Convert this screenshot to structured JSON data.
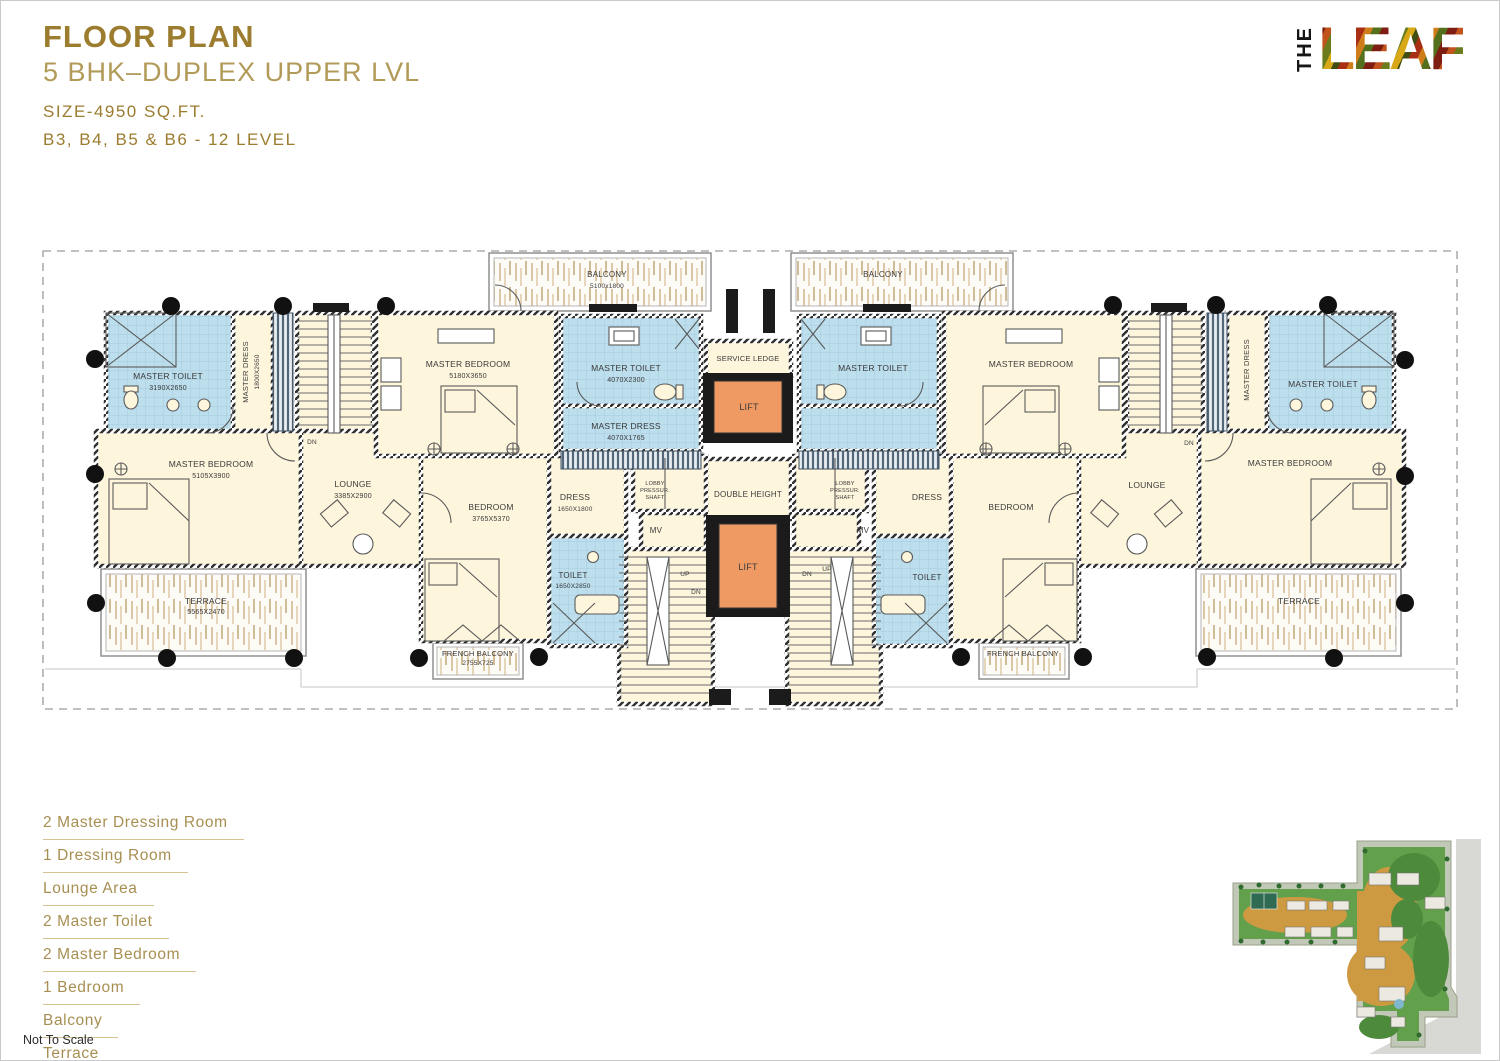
{
  "header": {
    "title": "FLOOR PLAN",
    "subtitle": "5 BHK–DUPLEX UPPER LVL",
    "size": "SIZE-4950 SQ.FT.",
    "blocks": "B3, B4, B5 & B6 - 12 LEVEL"
  },
  "logo": {
    "the": "THE",
    "leaf": "LEAF"
  },
  "features": {
    "items": [
      "2 Master Dressing Room",
      "1 Dressing Room",
      "Lounge Area",
      "2 Master Toilet",
      "2 Master Bedroom",
      "1 Bedroom",
      "Balcony",
      "Terrace"
    ]
  },
  "footnote": "Not To Scale",
  "colors": {
    "gold_dark": "#9c7c2e",
    "gold_mid": "#b29a58",
    "gold_list": "#a78f52",
    "gold_line": "#d4c291",
    "cream": "#fdf5dc",
    "wet_blue": "#bcdeed",
    "lift_orange": "#f09a63",
    "wall_dark": "#2f2f2f",
    "terrace_tan": "#d9c3a3"
  },
  "plan": {
    "labels": [
      {
        "t": "BALCONY",
        "x": 606,
        "y": 276,
        "s": 8
      },
      {
        "t": "5100x1800",
        "x": 606,
        "y": 287,
        "s": 6.5
      },
      {
        "t": "BALCONY",
        "x": 882,
        "y": 276,
        "s": 8
      },
      {
        "t": "SERVICE LEDGE",
        "x": 747,
        "y": 360,
        "s": 7.5
      },
      {
        "t": "LIFT",
        "x": 748,
        "y": 409,
        "s": 9
      },
      {
        "t": "DOUBLE HEIGHT",
        "x": 747,
        "y": 496,
        "s": 8
      },
      {
        "t": "LIFT",
        "x": 747,
        "y": 569,
        "s": 9
      },
      {
        "t": "MASTER TOILET",
        "x": 167,
        "y": 378,
        "s": 8.5
      },
      {
        "t": "3190X2650",
        "x": 167,
        "y": 389,
        "s": 7
      },
      {
        "t": "MASTER DRESS",
        "x": 247,
        "y": 371,
        "s": 7.5,
        "r": -90
      },
      {
        "t": "1800X2650",
        "x": 258,
        "y": 371,
        "s": 6.5,
        "r": -90
      },
      {
        "t": "MASTER BEDROOM",
        "x": 210,
        "y": 466,
        "s": 8.5
      },
      {
        "t": "5105X3900",
        "x": 210,
        "y": 477,
        "s": 7
      },
      {
        "t": "LOUNGE",
        "x": 352,
        "y": 486,
        "s": 8.5
      },
      {
        "t": "3385X2900",
        "x": 352,
        "y": 497,
        "s": 7
      },
      {
        "t": "DN",
        "x": 311,
        "y": 443,
        "s": 6.5
      },
      {
        "t": "MASTER BEDROOM",
        "x": 467,
        "y": 366,
        "s": 8.5
      },
      {
        "t": "5180X3650",
        "x": 467,
        "y": 377,
        "s": 7
      },
      {
        "t": "MASTER TOILET",
        "x": 625,
        "y": 370,
        "s": 8.5
      },
      {
        "t": "4070X2300",
        "x": 625,
        "y": 381,
        "s": 7
      },
      {
        "t": "MASTER DRESS",
        "x": 625,
        "y": 428,
        "s": 8.5
      },
      {
        "t": "4070X1765",
        "x": 625,
        "y": 439,
        "s": 7
      },
      {
        "t": "BEDROOM",
        "x": 490,
        "y": 509,
        "s": 8.5
      },
      {
        "t": "3765X5370",
        "x": 490,
        "y": 520,
        "s": 7
      },
      {
        "t": "DRESS",
        "x": 574,
        "y": 499,
        "s": 8.5
      },
      {
        "t": "1650X1800",
        "x": 574,
        "y": 510,
        "s": 6.5
      },
      {
        "t": "LOBBY",
        "x": 654,
        "y": 484,
        "s": 5.5
      },
      {
        "t": "PRESSUR.",
        "x": 654,
        "y": 491,
        "s": 5.5
      },
      {
        "t": "SHAFT",
        "x": 654,
        "y": 498,
        "s": 5.5
      },
      {
        "t": "MV",
        "x": 655,
        "y": 532,
        "s": 8
      },
      {
        "t": "TOILET",
        "x": 572,
        "y": 577,
        "s": 8
      },
      {
        "t": "1650X2850",
        "x": 572,
        "y": 587,
        "s": 6.5
      },
      {
        "t": "UP",
        "x": 684,
        "y": 575,
        "s": 6.5
      },
      {
        "t": "DN",
        "x": 695,
        "y": 593,
        "s": 6.5
      },
      {
        "t": "TERRACE",
        "x": 205,
        "y": 603,
        "s": 8.5
      },
      {
        "t": "5565X2470",
        "x": 205,
        "y": 613,
        "s": 7
      },
      {
        "t": "FRENCH BALCONY",
        "x": 477,
        "y": 655,
        "s": 7.5
      },
      {
        "t": "2755X725",
        "x": 477,
        "y": 664,
        "s": 6.5
      },
      {
        "t": "MASTER TOILET",
        "x": 872,
        "y": 370,
        "s": 8.5
      },
      {
        "t": "MASTER BEDROOM",
        "x": 1030,
        "y": 366,
        "s": 8.5
      },
      {
        "t": "BEDROOM",
        "x": 1010,
        "y": 509,
        "s": 8.5
      },
      {
        "t": "DRESS",
        "x": 926,
        "y": 499,
        "s": 8.5
      },
      {
        "t": "LOBBY",
        "x": 844,
        "y": 484,
        "s": 5.5
      },
      {
        "t": "PRESSUR.",
        "x": 844,
        "y": 491,
        "s": 5.5
      },
      {
        "t": "SHAFT",
        "x": 844,
        "y": 498,
        "s": 5.5
      },
      {
        "t": "MV",
        "x": 862,
        "y": 532,
        "s": 8
      },
      {
        "t": "TOILET",
        "x": 926,
        "y": 579,
        "s": 8
      },
      {
        "t": "DN",
        "x": 806,
        "y": 575,
        "s": 6.5
      },
      {
        "t": "UP",
        "x": 826,
        "y": 570,
        "s": 6.5
      },
      {
        "t": "LOUNGE",
        "x": 1146,
        "y": 487,
        "s": 8.5
      },
      {
        "t": "MASTER BEDROOM",
        "x": 1289,
        "y": 465,
        "s": 8.5
      },
      {
        "t": "MASTER DRESS",
        "x": 1248,
        "y": 369,
        "s": 7.5,
        "r": -90
      },
      {
        "t": "MASTER TOILET",
        "x": 1322,
        "y": 386,
        "s": 8.5
      },
      {
        "t": "DN",
        "x": 1188,
        "y": 444,
        "s": 6.5
      },
      {
        "t": "FRENCH BALCONY",
        "x": 1022,
        "y": 655,
        "s": 7.5
      },
      {
        "t": "TERRACE",
        "x": 1298,
        "y": 603,
        "s": 8.5
      }
    ],
    "columns": [
      [
        170,
        305
      ],
      [
        282,
        305
      ],
      [
        385,
        305
      ],
      [
        1112,
        304
      ],
      [
        1215,
        304
      ],
      [
        1327,
        304
      ],
      [
        94,
        358
      ],
      [
        94,
        473
      ],
      [
        95,
        602
      ],
      [
        1404,
        359
      ],
      [
        1404,
        475
      ],
      [
        1404,
        602
      ],
      [
        166,
        657
      ],
      [
        293,
        657
      ],
      [
        418,
        657
      ],
      [
        538,
        656
      ],
      [
        960,
        656
      ],
      [
        1082,
        656
      ],
      [
        1206,
        656
      ],
      [
        1333,
        657
      ]
    ]
  }
}
